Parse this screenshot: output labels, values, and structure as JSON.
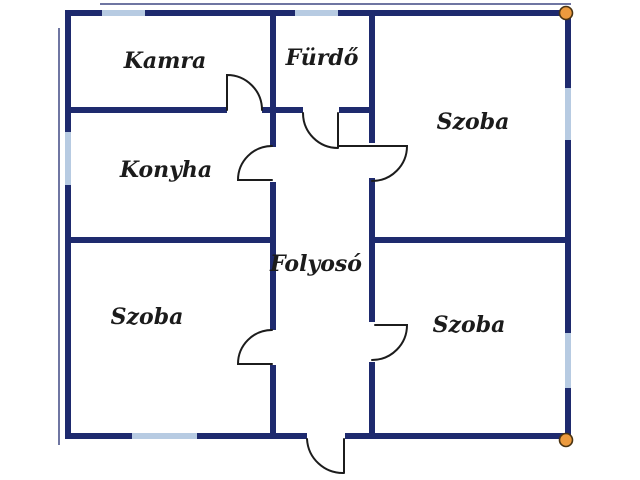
{
  "floorplan": {
    "colors": {
      "background": "#ffffff",
      "wall": "#1e2a6e",
      "window": "#b7cbe2",
      "door": "#1c1c1c",
      "marker_fill": "#ec9a3e",
      "marker_stroke": "#4a3312",
      "label": "#1b1b1b"
    },
    "rooms": [
      {
        "id": "kamra",
        "label": "Kamra"
      },
      {
        "id": "furdo",
        "label": "Fürdő"
      },
      {
        "id": "szoba-top-right",
        "label": "Szoba"
      },
      {
        "id": "konyha",
        "label": "Konyha"
      },
      {
        "id": "folyoso",
        "label": "Folyosó"
      },
      {
        "id": "szoba-bottom-left",
        "label": "Szoba"
      },
      {
        "id": "szoba-bottom-right",
        "label": "Szoba"
      }
    ]
  }
}
